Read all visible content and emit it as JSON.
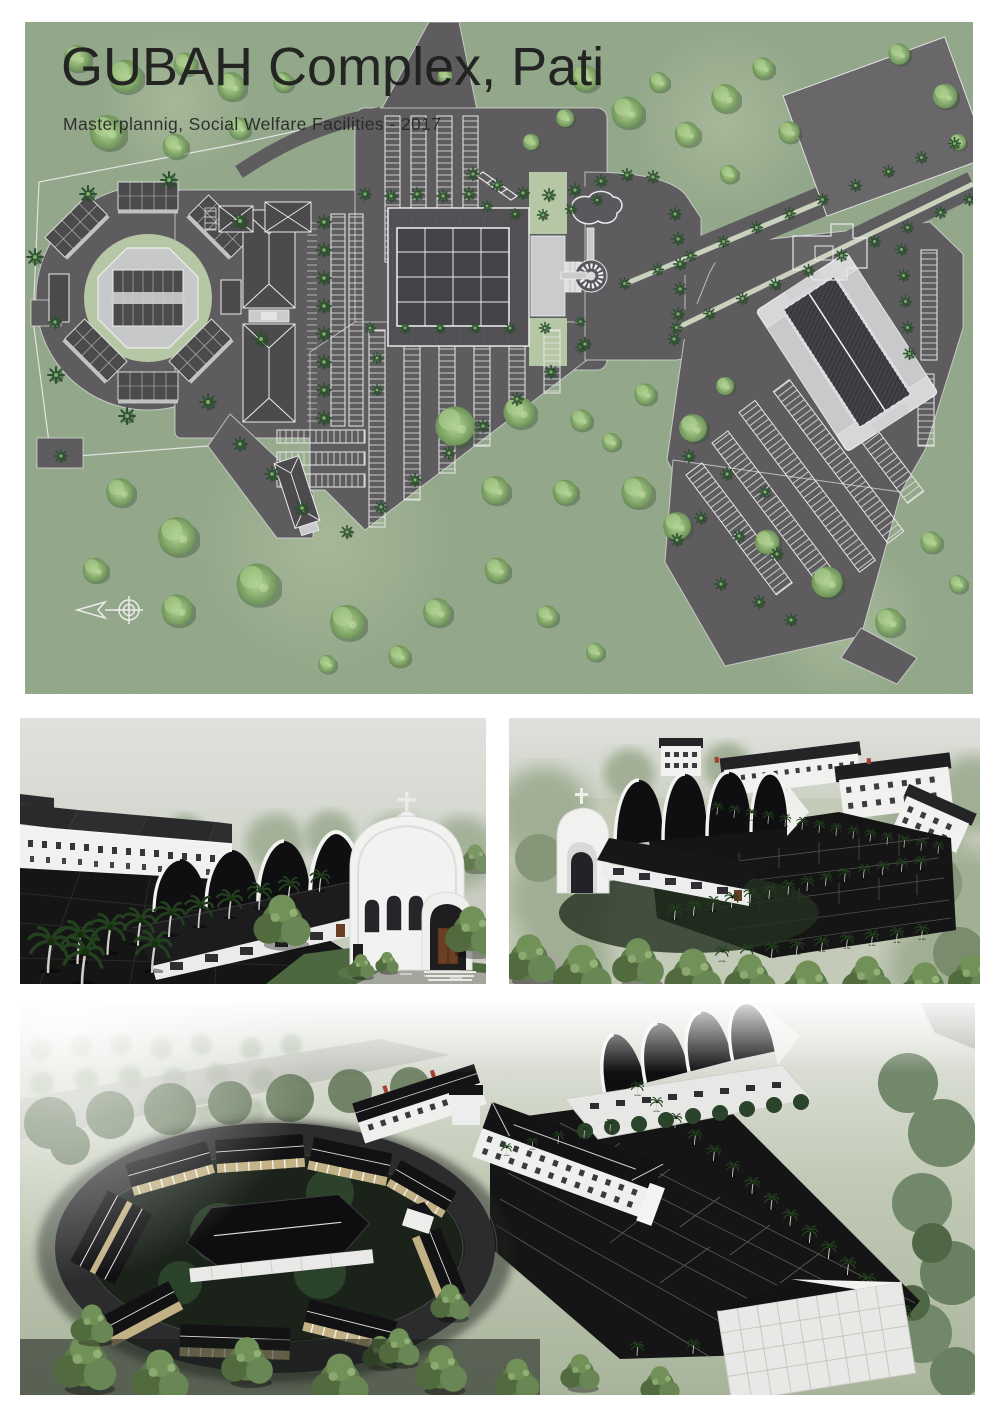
{
  "header": {
    "title": "GUBAH Complex, Pati",
    "subtitle": "Masterplannig, Social Welfare Facilities - 2017"
  },
  "icons": {
    "north_arrow": "north-arrow-compass"
  },
  "colors": {
    "paper": "#ffffff",
    "title_text": "#1e1e1e",
    "grass": "#9db394",
    "grass_light": "#b9c9aa",
    "lawn": "#b5c7a5",
    "asphalt": "#5e5c5f",
    "asphalt_light": "#69676a",
    "line_white": "#e6e6e6",
    "roof_plan": "#4c4a4d",
    "roof_black": "#161618",
    "wall_white": "#f1f2f0",
    "wall_light": "#c9cbcd",
    "wall_tan": "#c2b184",
    "palm": "#2c5230",
    "palm_render": "#23411f",
    "bush": "#83a86c",
    "sky": "#d8dad3",
    "ground_dark": "#151515",
    "haze_green": "#9cab90",
    "lawn_render": "#4d6841",
    "door_brown": "#6b3f26"
  }
}
